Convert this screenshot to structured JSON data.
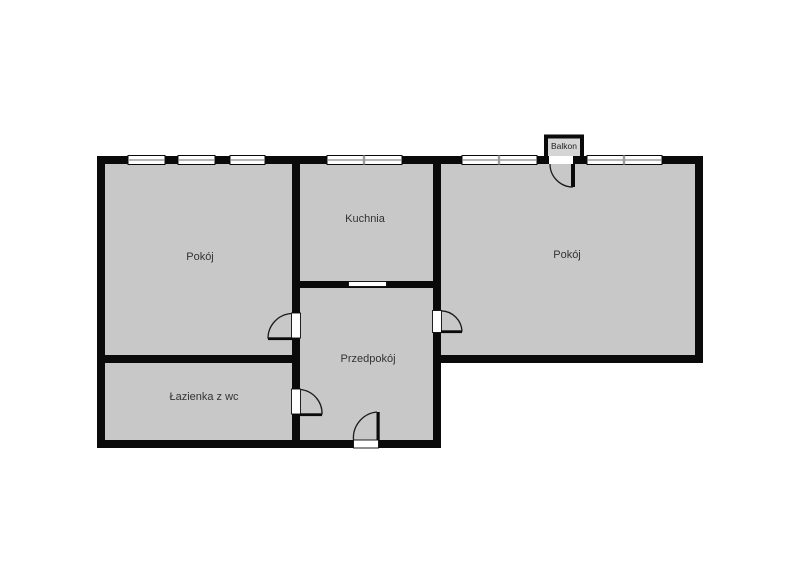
{
  "plan": {
    "rooms": [
      {
        "name": "pokoj-left",
        "label": "Pokój"
      },
      {
        "name": "kuchnia",
        "label": "Kuchnia"
      },
      {
        "name": "pokoj-right",
        "label": "Pokój"
      },
      {
        "name": "przedpokoj",
        "label": "Przedpokój"
      },
      {
        "name": "lazienka-z-wc",
        "label": "Łazienka z wc"
      },
      {
        "name": "balkon",
        "label": "Balkon"
      }
    ],
    "colors": {
      "background": "#ffffff",
      "floor": "#c8c8c8",
      "balcony_floor": "#d5d5d5",
      "wall": "#0a0a0a",
      "window": "#ffffff",
      "label_text": "#333333"
    }
  }
}
